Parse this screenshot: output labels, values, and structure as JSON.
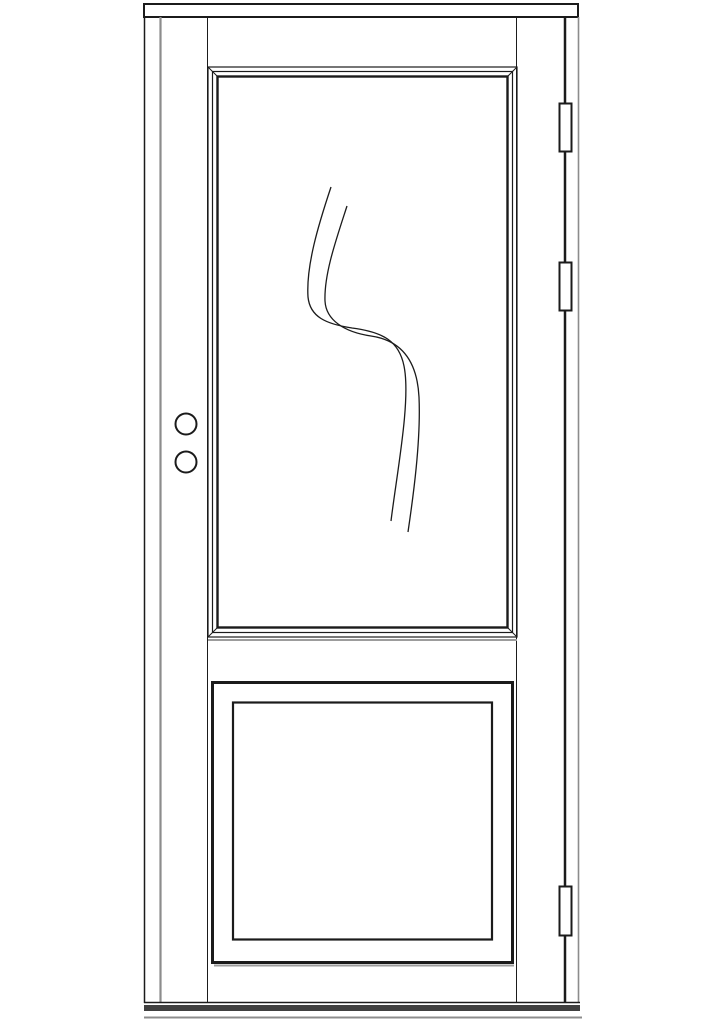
{
  "meta": {
    "description": "Technical elevation line drawing of a half-glass exterior door with lower raised panel, three hinges and two lock bores",
    "canvas": {
      "width": 724,
      "height": 1024
    }
  },
  "colors": {
    "paper": "#ffffff",
    "line": "#1b1b1b",
    "gray": "#8c8c8c",
    "shadow": "#9c9c9c",
    "threshold": "#3f3f3f",
    "white": "#ffffff"
  },
  "drawing": {
    "shapes": [
      {
        "type": "rect",
        "name": "frame-header",
        "x": 144,
        "y": 4,
        "w": 434,
        "h": 13,
        "stroke": "line",
        "width": 2,
        "fill": "white"
      },
      {
        "type": "line",
        "name": "frame-left-outer-edge",
        "x1": 144.5,
        "y1": 17,
        "x2": 144.5,
        "y2": 1003,
        "stroke": "line",
        "width": 1.5
      },
      {
        "type": "line",
        "name": "door-left-edge",
        "x1": 160.5,
        "y1": 17,
        "x2": 160.5,
        "y2": 1003,
        "stroke": "gray",
        "width": 2.2
      },
      {
        "type": "line",
        "name": "door-right-edge",
        "x1": 565,
        "y1": 17,
        "x2": 565,
        "y2": 1003,
        "stroke": "line",
        "width": 2.5
      },
      {
        "type": "line",
        "name": "frame-right-inner-edge",
        "x1": 578.5,
        "y1": 17,
        "x2": 578.5,
        "y2": 1003,
        "stroke": "gray",
        "width": 1.6
      },
      {
        "type": "line",
        "name": "door-stile-left",
        "x1": 207.5,
        "y1": 17,
        "x2": 207.5,
        "y2": 1003,
        "stroke": "line",
        "width": 1
      },
      {
        "type": "line",
        "name": "door-stile-right",
        "x1": 516.5,
        "y1": 17,
        "x2": 516.5,
        "y2": 1003,
        "stroke": "line",
        "width": 1
      },
      {
        "type": "line",
        "name": "door-bottom-edge",
        "x1": 144,
        "y1": 1002.5,
        "x2": 580,
        "y2": 1002.5,
        "stroke": "line",
        "width": 1.5
      },
      {
        "type": "rect",
        "name": "threshold-band",
        "x": 144,
        "y": 1005,
        "w": 436,
        "h": 6,
        "fill": "threshold"
      },
      {
        "type": "line",
        "name": "sill-bottom-line",
        "x1": 144,
        "y1": 1017.5,
        "x2": 582,
        "y2": 1017.5,
        "stroke": "gray",
        "width": 2
      },
      {
        "type": "rect",
        "name": "glass-molding-outer",
        "x": 208,
        "y": 67,
        "w": 309,
        "h": 570,
        "stroke": "line",
        "width": 1.2,
        "fill": "none"
      },
      {
        "type": "rect",
        "name": "glass-molding-middle",
        "x": 212.5,
        "y": 71.5,
        "w": 300,
        "h": 561,
        "stroke": "line",
        "width": 1.2,
        "fill": "none"
      },
      {
        "type": "rect",
        "name": "glass-molding-inner",
        "x": 217.5,
        "y": 76.5,
        "w": 290,
        "h": 551,
        "stroke": "line",
        "width": 2.4,
        "fill": "none"
      },
      {
        "type": "line",
        "name": "molding-bevel-top-left",
        "x1": 208,
        "y1": 67,
        "x2": 218,
        "y2": 77,
        "stroke": "line",
        "width": 1
      },
      {
        "type": "line",
        "name": "molding-bevel-top-right",
        "x1": 517,
        "y1": 67,
        "x2": 507,
        "y2": 77,
        "stroke": "line",
        "width": 1
      },
      {
        "type": "line",
        "name": "molding-bevel-bottom-left",
        "x1": 208,
        "y1": 637,
        "x2": 218,
        "y2": 627,
        "stroke": "line",
        "width": 1
      },
      {
        "type": "line",
        "name": "molding-bevel-bottom-right",
        "x1": 517,
        "y1": 637,
        "x2": 507,
        "y2": 627,
        "stroke": "line",
        "width": 1
      },
      {
        "type": "line",
        "name": "glass-molding-shadow",
        "x1": 208,
        "y1": 640,
        "x2": 517,
        "y2": 640,
        "stroke": "shadow",
        "width": 2
      },
      {
        "type": "path",
        "name": "glass-ornament-curve-1",
        "d": "M 331 187 C 318 226 306 266 308 297 C 310 317 326 324 352 328 C 383 332 399 341 404 366 C 411 400 397 472 391 521",
        "stroke": "line",
        "width": 1.3,
        "fill": "none"
      },
      {
        "type": "path",
        "name": "glass-ornament-curve-2",
        "d": "M 347 206 C 336 240 324 274 325 301 C 326 320 344 332 371 336 C 399 340 417 358 419 397 C 421 441 413 498 408 532",
        "stroke": "line",
        "width": 1.3,
        "fill": "none"
      },
      {
        "type": "rect",
        "name": "bottom-panel-outer",
        "x": 212.5,
        "y": 682.5,
        "w": 300,
        "h": 280,
        "stroke": "line",
        "width": 3,
        "fill": "none"
      },
      {
        "type": "rect",
        "name": "bottom-panel-inner",
        "x": 233,
        "y": 702.5,
        "w": 259,
        "h": 237,
        "stroke": "line",
        "width": 2.2,
        "fill": "none"
      },
      {
        "type": "line",
        "name": "bottom-panel-shadow",
        "x1": 214,
        "y1": 965.5,
        "x2": 514,
        "y2": 965.5,
        "stroke": "shadow",
        "width": 2
      },
      {
        "type": "circle",
        "name": "handle-bore-upper",
        "cx": 186,
        "cy": 424,
        "r": 10.5,
        "stroke": "line",
        "width": 2,
        "fill": "white"
      },
      {
        "type": "circle",
        "name": "deadbolt-bore-lower",
        "cx": 186,
        "cy": 462,
        "r": 10.5,
        "stroke": "line",
        "width": 2,
        "fill": "white"
      },
      {
        "type": "rect",
        "name": "hinge-top",
        "x": 559.5,
        "y": 103.5,
        "w": 12,
        "h": 48,
        "stroke": "line",
        "width": 2,
        "fill": "white"
      },
      {
        "type": "rect",
        "name": "hinge-middle",
        "x": 559.5,
        "y": 262.5,
        "w": 12,
        "h": 48,
        "stroke": "line",
        "width": 2,
        "fill": "white"
      },
      {
        "type": "rect",
        "name": "hinge-bottom",
        "x": 559.5,
        "y": 886.5,
        "w": 12,
        "h": 49,
        "stroke": "line",
        "width": 2,
        "fill": "white"
      }
    ]
  }
}
